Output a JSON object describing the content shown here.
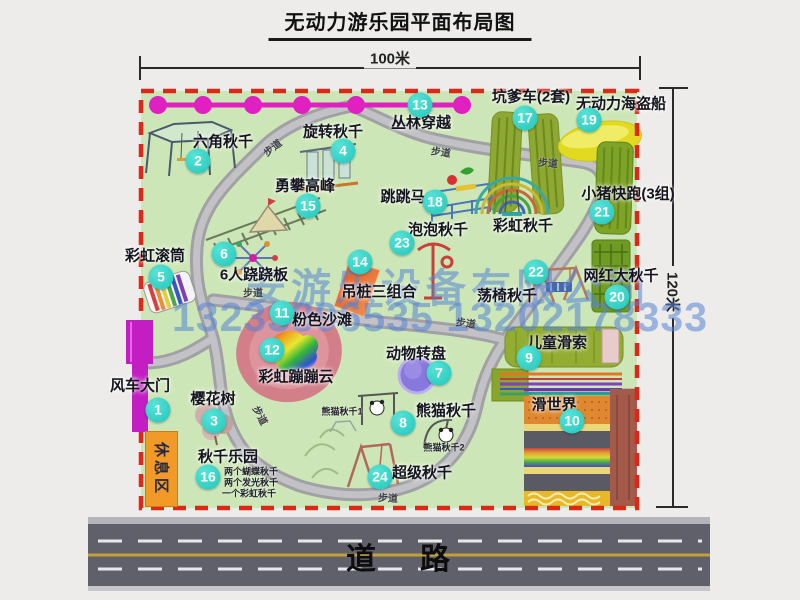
{
  "title": "无动力游乐园平面布局图",
  "dimensions": {
    "width_label": "100米",
    "height_label": "120米"
  },
  "road": {
    "label": "道路"
  },
  "watermark": {
    "line1": "安游乐设备有限公司",
    "line2": "13233896535 13202178333"
  },
  "colors": {
    "page_bg": "#edecea",
    "map_bg": "#cde6b7",
    "border_red": "#de2715",
    "bubble_teal": "#2fd8cc",
    "road_gray": "#60606a",
    "gate_magenta": "#c21ec2",
    "rest_orange": "#f19a28",
    "watermark_blue": "#5584d6"
  },
  "map": {
    "rest_area_label": "休息区",
    "zone_labels": [
      {
        "text": "彩虹秋千",
        "x": 523,
        "y": 225
      }
    ],
    "walkway_labels": [
      {
        "text": "步道",
        "x": 272,
        "y": 147,
        "rot": -38
      },
      {
        "text": "步道",
        "x": 441,
        "y": 151,
        "rot": 8
      },
      {
        "text": "步道",
        "x": 548,
        "y": 162,
        "rot": 4
      },
      {
        "text": "步道",
        "x": 253,
        "y": 292,
        "rot": 0
      },
      {
        "text": "步道",
        "x": 261,
        "y": 415,
        "rot": 62
      },
      {
        "text": "步道",
        "x": 388,
        "y": 497,
        "rot": 3
      },
      {
        "text": "步道",
        "x": 466,
        "y": 322,
        "rot": 8
      }
    ],
    "items": [
      {
        "num": 1,
        "label": "风车大门",
        "lx": 140,
        "ly": 385,
        "bx": 158,
        "by": 410
      },
      {
        "num": 2,
        "label": "六角秋千",
        "lx": 223,
        "ly": 141,
        "bx": 198,
        "by": 161
      },
      {
        "num": 3,
        "label": "樱花树",
        "lx": 213,
        "ly": 398,
        "bx": 214,
        "by": 421
      },
      {
        "num": 4,
        "label": "旋转秋千",
        "lx": 333,
        "ly": 131,
        "bx": 343,
        "by": 151
      },
      {
        "num": 5,
        "label": "彩虹滚筒",
        "lx": 155,
        "ly": 255,
        "bx": 161,
        "by": 277
      },
      {
        "num": 6,
        "label": "6人跷跷板",
        "lx": 254,
        "ly": 274,
        "bx": 224,
        "by": 254
      },
      {
        "num": 7,
        "label": "动物转盘",
        "lx": 416,
        "ly": 353,
        "bx": 439,
        "by": 373
      },
      {
        "num": 8,
        "label": "熊猫秋千",
        "lx": 446,
        "ly": 410,
        "bx": 403,
        "by": 423,
        "notes": [
          {
            "text": "熊猫秋千1",
            "x": 342,
            "y": 411
          },
          {
            "text": "熊猫秋千2",
            "x": 444,
            "y": 447
          }
        ]
      },
      {
        "num": 9,
        "label": "儿童滑索",
        "lx": 557,
        "ly": 342,
        "bx": 529,
        "by": 358
      },
      {
        "num": 10,
        "label": "滑世界",
        "lx": 554,
        "ly": 404,
        "bx": 572,
        "by": 421
      },
      {
        "num": 11,
        "label": "粉色沙滩",
        "lx": 322,
        "ly": 319,
        "bx": 282,
        "by": 313
      },
      {
        "num": 12,
        "label": "彩虹蹦蹦云",
        "lx": 296,
        "ly": 376,
        "bx": 272,
        "by": 350
      },
      {
        "num": 13,
        "label": "丛林穿越",
        "lx": 421,
        "ly": 122,
        "bx": 420,
        "by": 105
      },
      {
        "num": 14,
        "label": "吊桩三组合",
        "lx": 379,
        "ly": 291,
        "bx": 360,
        "by": 262
      },
      {
        "num": 15,
        "label": "勇攀高峰",
        "lx": 305,
        "ly": 185,
        "bx": 308,
        "by": 206
      },
      {
        "num": 16,
        "label": "秋千乐园",
        "lx": 228,
        "ly": 456,
        "bx": 208,
        "by": 477,
        "notes": [
          {
            "text": "两个蝴蝶秋千",
            "x": 251,
            "y": 471
          },
          {
            "text": "两个发光秋千",
            "x": 251,
            "y": 482
          },
          {
            "text": "一个彩虹秋千",
            "x": 249,
            "y": 493
          }
        ]
      },
      {
        "num": 17,
        "label": "坑爹车(2套)",
        "lx": 531,
        "ly": 96,
        "bx": 525,
        "by": 118
      },
      {
        "num": 18,
        "label": "跳跳马",
        "lx": 403,
        "ly": 196,
        "bx": 435,
        "by": 202
      },
      {
        "num": 19,
        "label": "无动力海盗船",
        "lx": 621,
        "ly": 103,
        "bx": 589,
        "by": 120
      },
      {
        "num": 20,
        "label": "网红大秋千",
        "lx": 621,
        "ly": 275,
        "bx": 617,
        "by": 297
      },
      {
        "num": 21,
        "label": "小猪快跑(3组)",
        "lx": 628,
        "ly": 193,
        "bx": 602,
        "by": 212
      },
      {
        "num": 22,
        "label": "荡椅秋千",
        "lx": 507,
        "ly": 295,
        "bx": 536,
        "by": 272
      },
      {
        "num": 23,
        "label": "泡泡秋千",
        "lx": 438,
        "ly": 229,
        "bx": 402,
        "by": 243
      },
      {
        "num": 24,
        "label": "超级秋千",
        "lx": 422,
        "ly": 472,
        "bx": 380,
        "by": 477
      }
    ]
  }
}
